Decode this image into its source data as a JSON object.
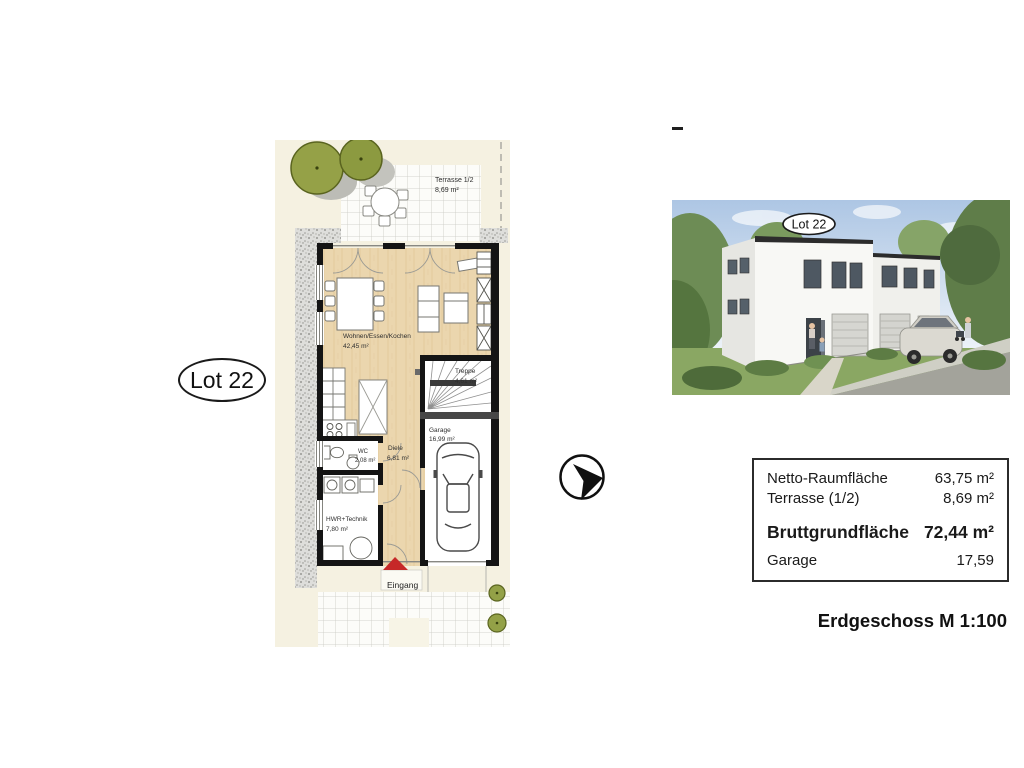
{
  "labels": {
    "lot": "Lot 22",
    "entrance": "Eingang"
  },
  "floor_plan": {
    "rooms": [
      {
        "name": "Terrasse 1/2",
        "area": "8,69 m²"
      },
      {
        "name": "Wohnen/Essen/Kochen",
        "area": "42,45 m²"
      },
      {
        "name": "Treppe",
        "area": "4,61 m²"
      },
      {
        "name": "Garage",
        "area": "16,99 m²"
      },
      {
        "name": "WC",
        "area": "2,08 m²"
      },
      {
        "name": "Diele",
        "area": "6,81 m²"
      },
      {
        "name": "HWR+Technik",
        "area": "7,80 m²"
      }
    ]
  },
  "area_table": {
    "rows": [
      {
        "label": "Netto-Raumfläche",
        "value": "63,75 m²",
        "bold": false
      },
      {
        "label": "Terrasse (1/2)",
        "value": "8,69 m²",
        "bold": false
      },
      {
        "label": "Bruttgrundfläche",
        "value": "72,44 m²",
        "bold": true
      },
      {
        "label": "Garage",
        "value": "17,59",
        "bold": false
      }
    ]
  },
  "caption": "Erdgeschoss M 1:100",
  "icons": {
    "north_arrow": "north-arrow-icon"
  },
  "colors": {
    "plan_background": "#f5f1e1",
    "wall_black": "#141414",
    "floor_wood": "#ebd6ae",
    "entrance_arrow_red": "#c62828",
    "tree_green": "#95a147",
    "gravel_gray": "#dededb",
    "sky_blue": "#adc6e4",
    "grass_green": "#8aa763"
  }
}
